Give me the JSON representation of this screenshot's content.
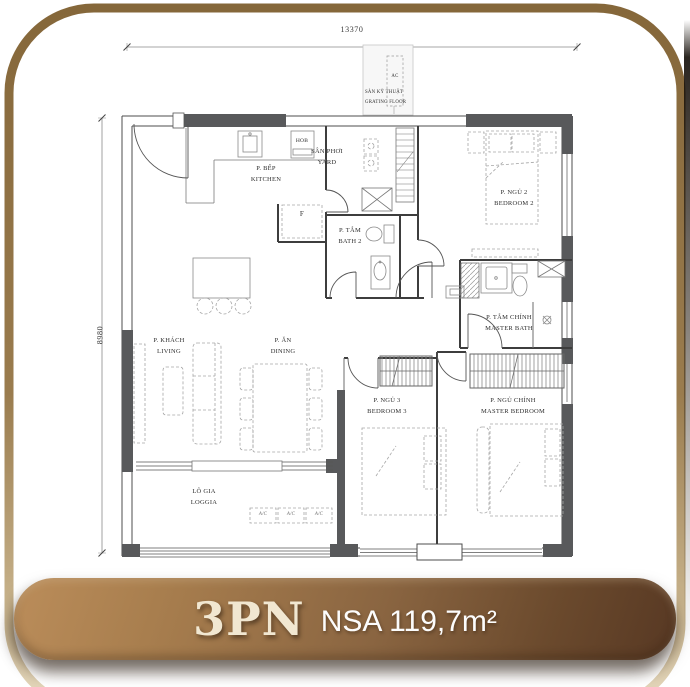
{
  "plan": {
    "dimensions": {
      "top": "13370",
      "left": "8980"
    },
    "technical_floor": {
      "vi": "SÀN KỸ THUẬT",
      "en": "GRATING FLOOR",
      "ac": "AC"
    },
    "rooms": {
      "kitchen": {
        "vi": "P. BẾP",
        "en": "KITCHEN"
      },
      "yard": {
        "vi": "SÂN PHƠI",
        "en": "YARD"
      },
      "bath2": {
        "vi": "P. TẮM",
        "en": "BATH 2"
      },
      "bedroom2": {
        "vi": "P. NGỦ 2",
        "en": "BEDROOM 2"
      },
      "master_bath": {
        "vi": "P. TẮM CHÍNH",
        "en": "MASTER BATH"
      },
      "living": {
        "vi": "P. KHÁCH",
        "en": "LIVING"
      },
      "dining": {
        "vi": "P. ĂN",
        "en": "DINING"
      },
      "bedroom3": {
        "vi": "P. NGỦ 3",
        "en": "BEDROOM 3"
      },
      "master_bedroom": {
        "vi": "P. NGỦ CHÍNH",
        "en": "MASTER BEDROOM"
      },
      "loggia": {
        "vi": "LÔ GIA",
        "en": "LOGGIA"
      }
    },
    "appliances": {
      "hob": "HOB",
      "fridge": "F",
      "ac_unit": "A/C"
    }
  },
  "banner": {
    "unit": "3PN",
    "area": "NSA 119,7m²"
  },
  "colors": {
    "frame_brown": "#8a6c3d",
    "banner_light": "#bb8d5a",
    "banner_dark": "#573823",
    "wall_fill": "#58595b",
    "banner_text_cream": "#f1e7d1"
  }
}
